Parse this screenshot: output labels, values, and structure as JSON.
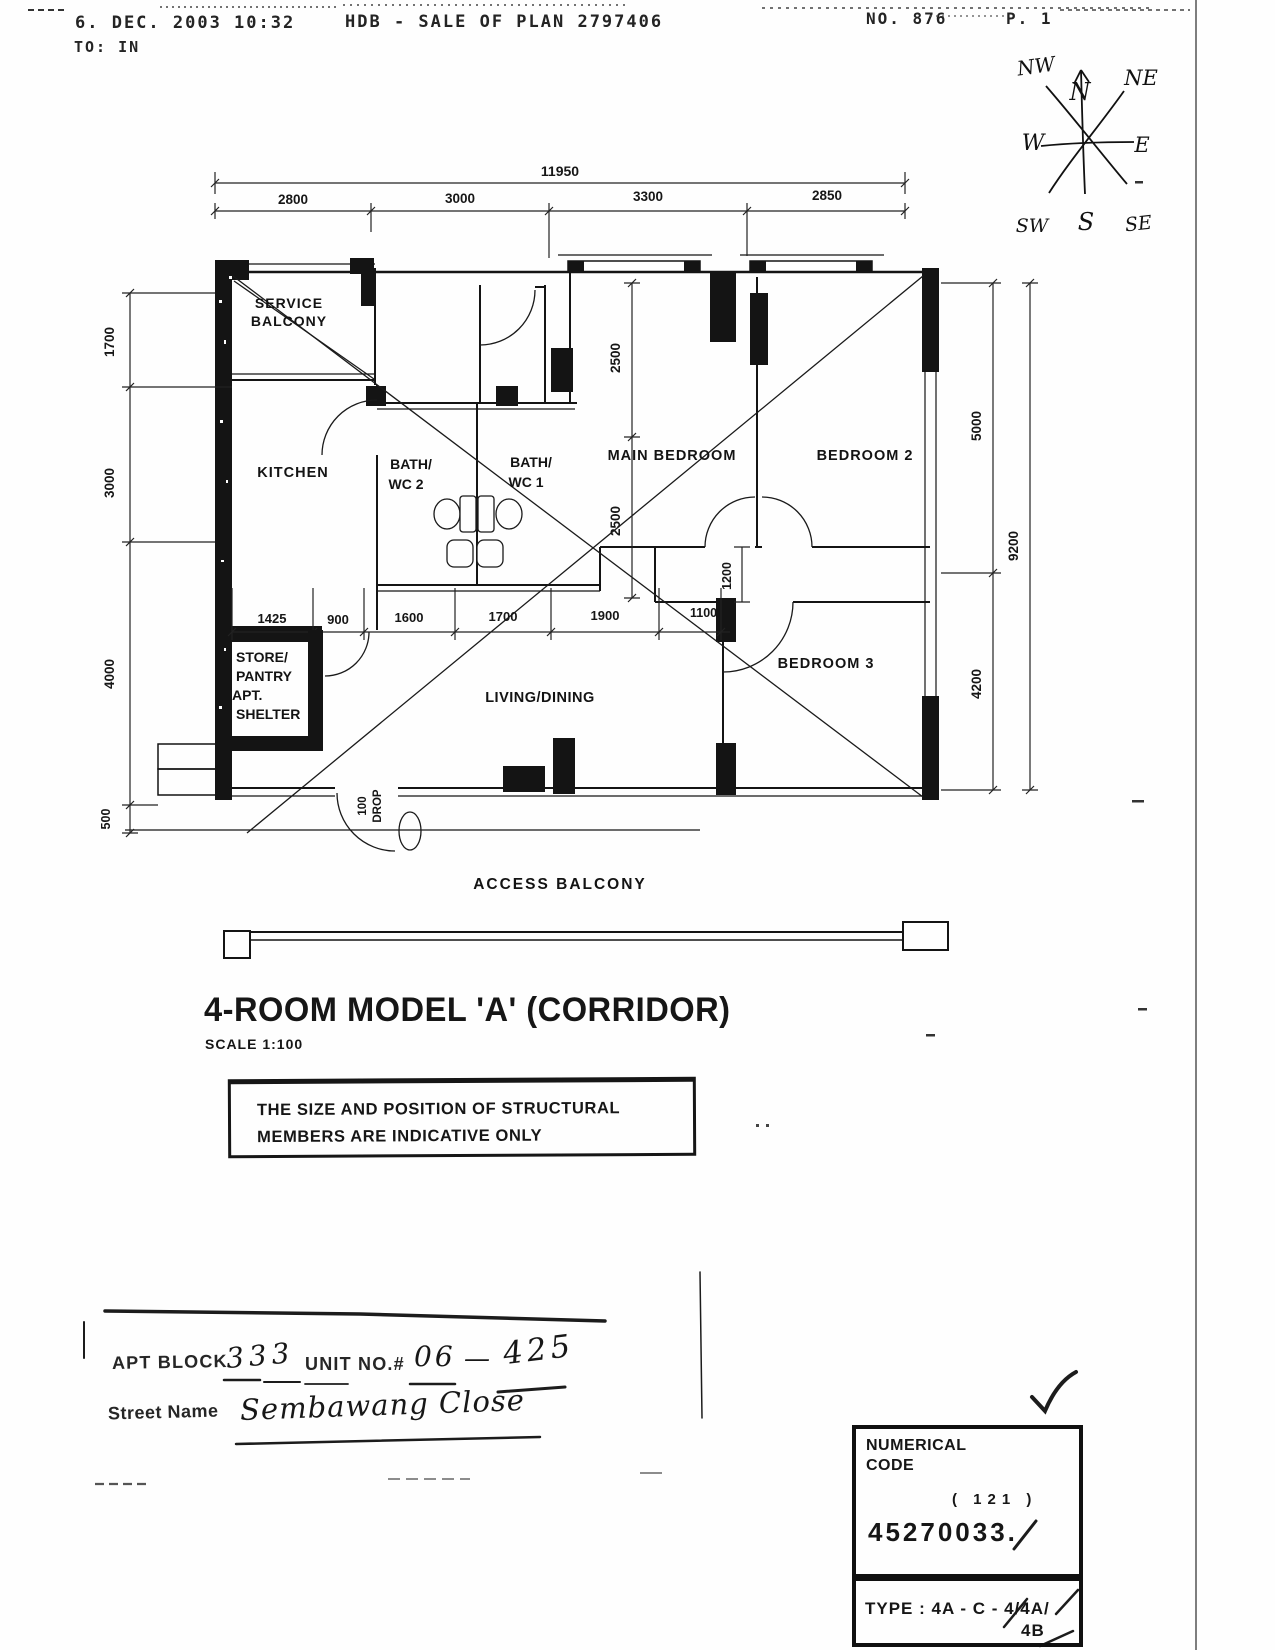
{
  "fax_header": {
    "datetime": "6. DEC. 2003 10:32",
    "subject": "HDB - SALE OF PLAN 2797406",
    "fax_no": "NO. 876",
    "page_no": "P.  1",
    "to_line": "TO: IN"
  },
  "compass": {
    "n": "N",
    "ne": "NE",
    "e": "E",
    "se": "SE",
    "s": "S",
    "sw": "SW",
    "w": "W",
    "nw": "NW"
  },
  "plan": {
    "rooms": {
      "service_balcony": [
        "SERVICE",
        "BALCONY"
      ],
      "kitchen": "KITCHEN",
      "bath2": [
        "BATH/",
        "WC 2"
      ],
      "bath1": [
        "BATH/",
        "WC 1"
      ],
      "main_bedroom": "MAIN BEDROOM",
      "bedroom2": "BEDROOM 2",
      "store": [
        "STORE/",
        "PANTRY",
        "APT.",
        "SHELTER"
      ],
      "living": "LIVING/DINING",
      "bedroom3": "BEDROOM 3",
      "access_balcony": "ACCESS  BALCONY",
      "drop": [
        "100",
        "DROP"
      ]
    },
    "dimensions": {
      "overall_width": "11950",
      "top": [
        "2800",
        "3000",
        "3300",
        "2850"
      ],
      "left": [
        "1700",
        "3000",
        "4000",
        "500"
      ],
      "right": [
        "5000",
        "4200"
      ],
      "overall_height": "9200",
      "middle": [
        "1425",
        "900",
        "1600",
        "1700",
        "1900",
        "1100"
      ],
      "bedroom_depth": [
        "2500",
        "2500"
      ],
      "corridor": "1200"
    }
  },
  "title_block": {
    "title": "4-ROOM MODEL 'A' (CORRIDOR)",
    "scale": "SCALE 1:100"
  },
  "notice": {
    "line1": "THE SIZE AND POSITION OF STRUCTURAL",
    "line2": "MEMBERS ARE INDICATIVE ONLY"
  },
  "address_form": {
    "apt_block_label": "APT BLOCK",
    "apt_block_value": "333",
    "unit_label": "UNIT NO.#",
    "unit_value": "06",
    "unit_dash": "—",
    "unit_value2": "425",
    "street_label": "Street Name",
    "street_value": "Sembawang Close"
  },
  "code_box": {
    "header1": "NUMERICAL",
    "header2": "CODE",
    "paren": "( 121 )",
    "code": "45270033.",
    "type_line": "TYPE : 4A - C - 4/4A/",
    "type_line2": "4B"
  }
}
